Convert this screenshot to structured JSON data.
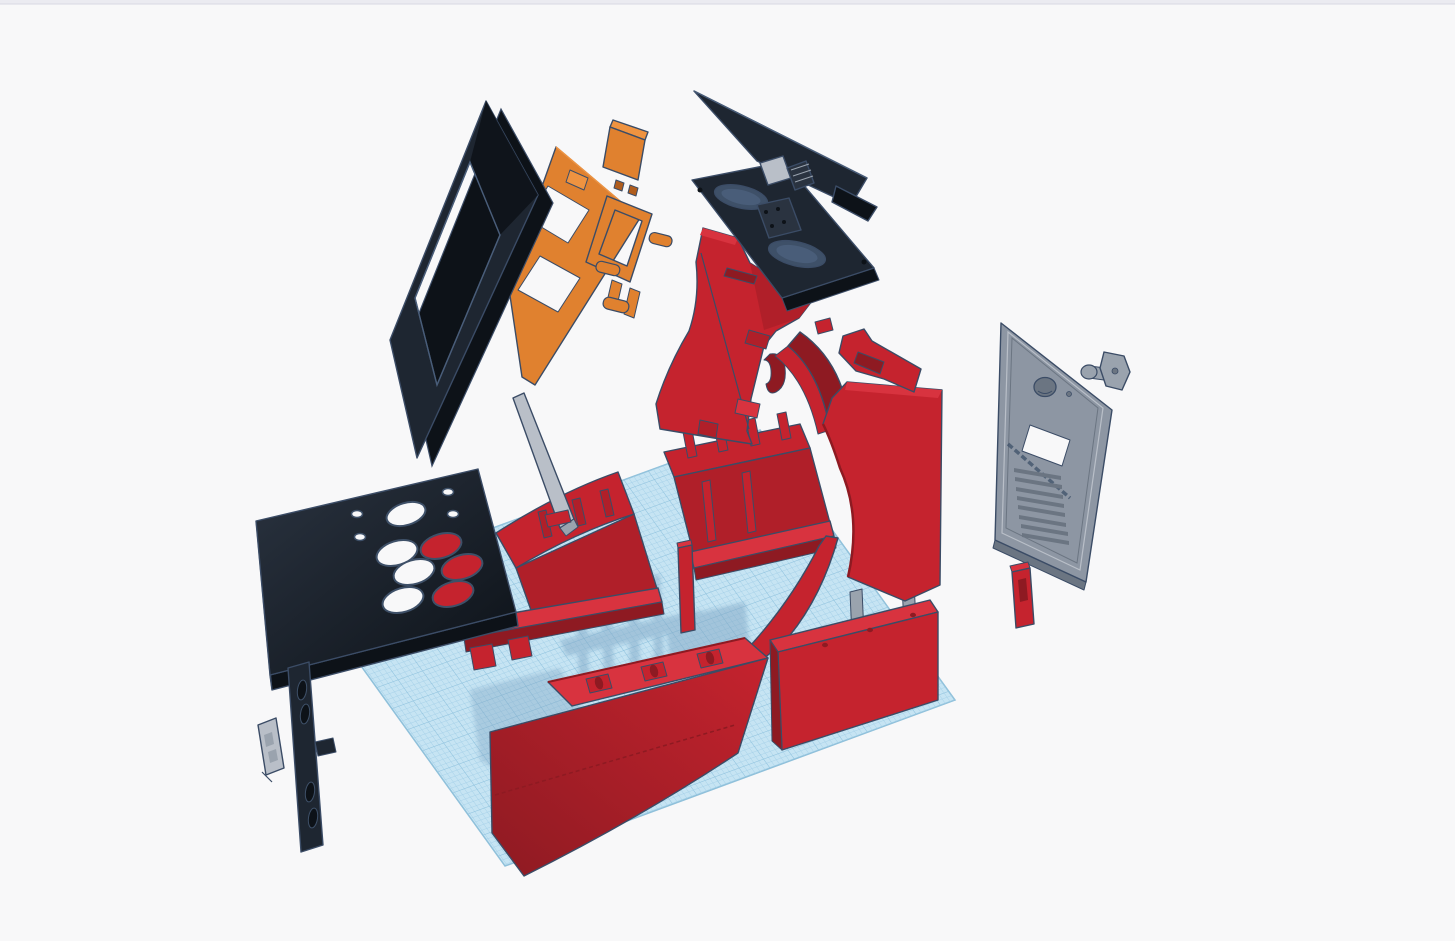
{
  "app": {
    "name": "3D design viewport",
    "view_label": "exploded arcade cabinet model",
    "top_strip_visible": true
  },
  "palette": {
    "background": "#f8f8f9",
    "topStrip": "#ebebf1",
    "topStripLine": "#d8d8e2",
    "outline": "#3b4c66",
    "red": "#c5232e",
    "redBright": "#d8333f",
    "redMid": "#b01f29",
    "redDark": "#8e1a22",
    "black": "#1e2631",
    "blackLight": "#2a3340",
    "blackDark": "#0d1218",
    "slate": "#3e5068",
    "slateLight": "#495d79",
    "orange": "#e0812f",
    "orangeDark": "#b05d1d",
    "orangeLight": "#ef9340",
    "gray": "#8d96a3",
    "grayLight": "#b9bfc8",
    "grayMid": "#9aa3ae",
    "grayDark": "#6b7582",
    "planeFill": "#c6e4f3",
    "planeLine": "#9fcce6",
    "planeLineMajor": "#8cc0dc",
    "planeEdge": "#8fc0da",
    "shadow": "#7fa6c4"
  },
  "parts": [
    {
      "id": "workplane",
      "label": "Workplane grid",
      "color": "blue"
    },
    {
      "id": "base-box-left",
      "label": "Base box left",
      "color": "red"
    },
    {
      "id": "base-box-right",
      "label": "Base box right",
      "color": "red"
    },
    {
      "id": "corner-stud",
      "label": "Corner stud",
      "color": "red"
    },
    {
      "id": "support-post",
      "label": "Angled support post",
      "color": "gray"
    },
    {
      "id": "left-side-panel",
      "label": "Left side panel",
      "color": "red"
    },
    {
      "id": "side-arc-panel",
      "label": "Side arc panel",
      "color": "red"
    },
    {
      "id": "speaker-panel",
      "label": "Speaker panel",
      "color": "black"
    },
    {
      "id": "marquee-panel",
      "label": "Marquee panel",
      "color": "black"
    },
    {
      "id": "marquee-hinge",
      "label": "Marquee hinge",
      "color": "gray"
    },
    {
      "id": "blade-panel",
      "label": "Curved blade panel",
      "color": "red"
    },
    {
      "id": "right-side-panel",
      "label": "Right side panel",
      "color": "red"
    },
    {
      "id": "panel-hook",
      "label": "Side panel hook",
      "color": "red"
    },
    {
      "id": "front-kick-assembly",
      "label": "Front kick assembly",
      "color": "red"
    },
    {
      "id": "back-lower-box",
      "label": "Back lower box",
      "color": "red"
    },
    {
      "id": "gray-posts",
      "label": "Support posts",
      "color": "gray"
    },
    {
      "id": "monitor-mount",
      "label": "Monitor mount frame",
      "color": "orange"
    },
    {
      "id": "monitor-bracket",
      "label": "Monitor bracket",
      "color": "orange"
    },
    {
      "id": "mount-block",
      "label": "Mount block",
      "color": "orange"
    },
    {
      "id": "screen-bezel",
      "label": "Screen bezel frame",
      "color": "black"
    },
    {
      "id": "control-panel",
      "label": "Control panel",
      "color": "black"
    },
    {
      "id": "joystick-plate",
      "label": "Joystick plate",
      "color": "black"
    },
    {
      "id": "small-bracket",
      "label": "Small mounting bracket",
      "color": "gray"
    },
    {
      "id": "back-door",
      "label": "Back access door",
      "color": "gray"
    },
    {
      "id": "lock-set",
      "label": "Lock barrel and key",
      "color": "gray"
    },
    {
      "id": "latch-stick",
      "label": "Latch stick",
      "color": "red"
    }
  ]
}
